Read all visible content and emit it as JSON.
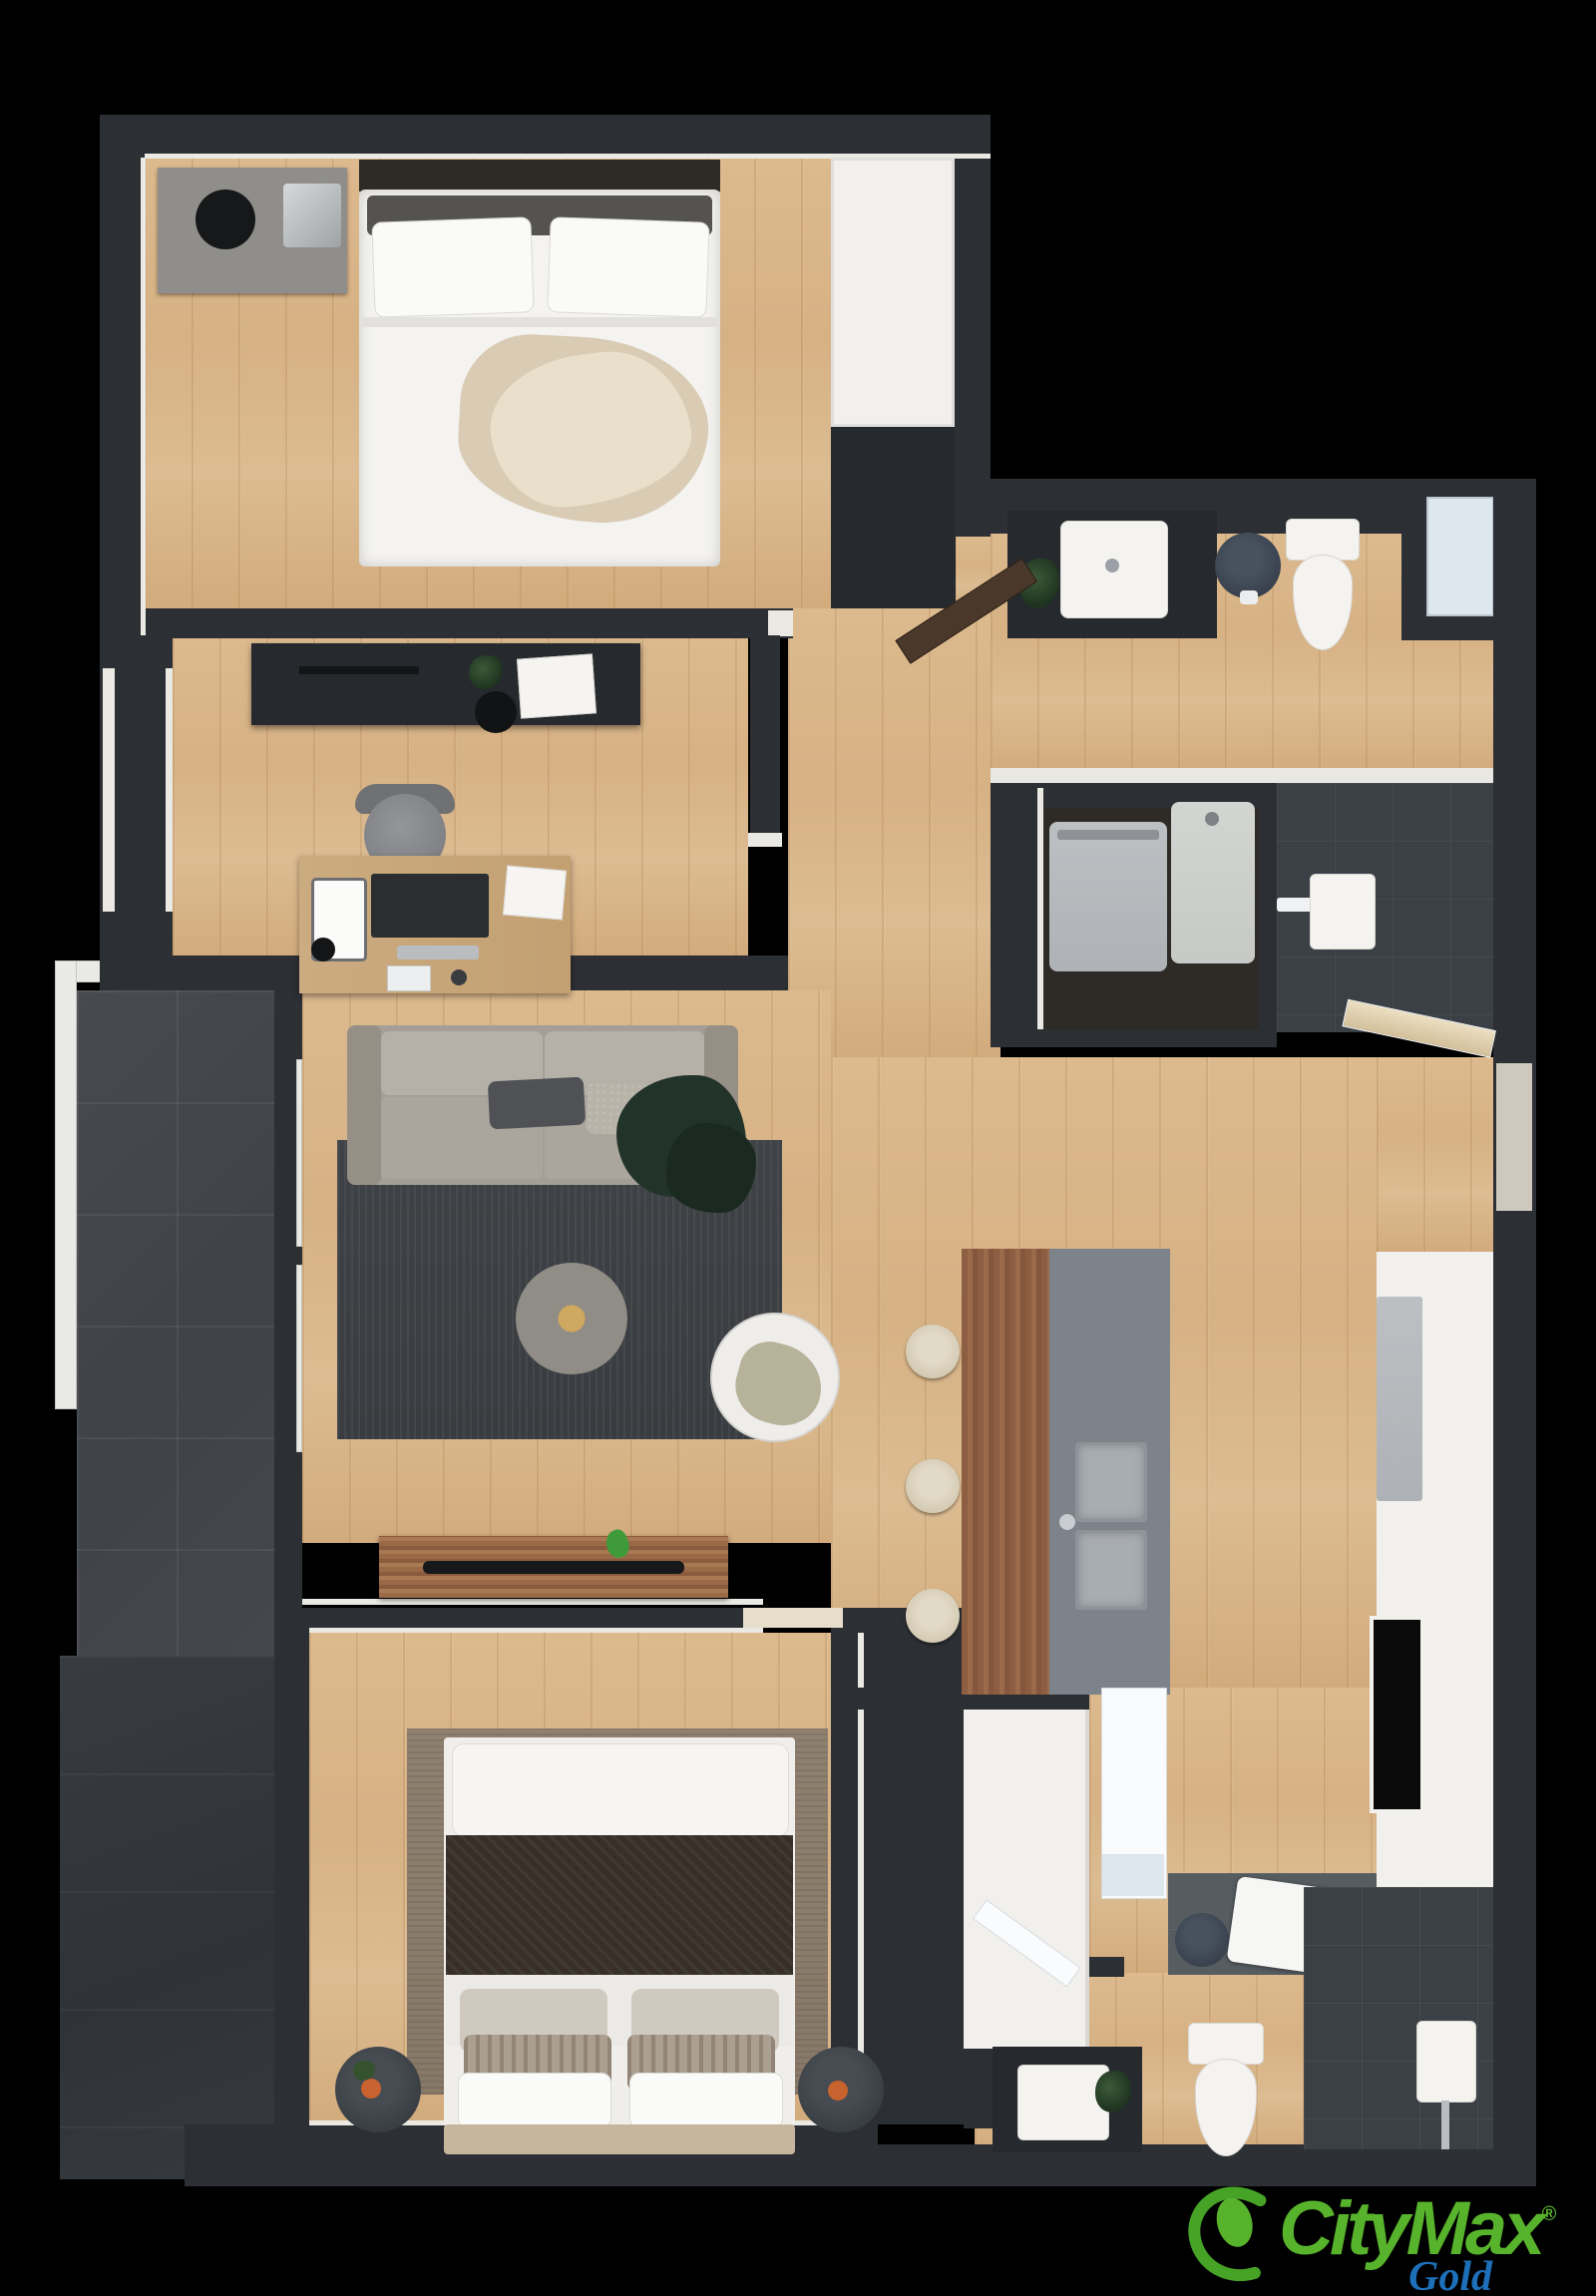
{
  "brand": {
    "name": "CityMax",
    "registered": "®",
    "edition": "Gold",
    "green": "#58b32c",
    "blue": "#1e6fba"
  },
  "plan": {
    "type": "apartment-floor-plan",
    "style": "3d-top-down-render",
    "palette": {
      "background": "#000000",
      "wall": "#2c2f33",
      "wood_floor": "#d6b184",
      "balcony_tile": "#42474c",
      "shower_tile": "#3a4046",
      "living_rug": "#3d4045",
      "bedroom_rug": "#8b7c6c",
      "fixture_white": "#f4f3f0",
      "island_counter": "#7d838b",
      "island_bar_wood": "#8d5e42"
    },
    "rooms": [
      {
        "id": "bedroom-1",
        "label": "Bedroom 1",
        "items": [
          "double-bed",
          "nightstand",
          "white-wardrobe"
        ]
      },
      {
        "id": "office",
        "label": "Office / Second Bedroom",
        "items": [
          "desk",
          "desk-chair",
          "dresser",
          "window"
        ]
      },
      {
        "id": "bathroom-1",
        "label": "Bathroom 1",
        "items": [
          "vanity-sink",
          "plant",
          "stool",
          "toilet",
          "window"
        ]
      },
      {
        "id": "laundry",
        "label": "Laundry Closet",
        "items": [
          "washer",
          "dryer",
          "walk-in-shower"
        ]
      },
      {
        "id": "living-room",
        "label": "Living Room",
        "items": [
          "sofa",
          "area-rug",
          "pouf",
          "side-table",
          "tv-console",
          "balcony-sliding-door"
        ]
      },
      {
        "id": "kitchen",
        "label": "Kitchen / Dining",
        "items": [
          "island-breakfast-bar",
          "bar-stools",
          "double-sink",
          "wall-counter",
          "cooktop",
          "oven",
          "entrance-door",
          "white-wardrobe"
        ]
      },
      {
        "id": "bedroom-2",
        "label": "Bedroom 2",
        "items": [
          "double-bed",
          "area-rug",
          "nightstand-left",
          "nightstand-right"
        ]
      },
      {
        "id": "bathroom-2",
        "label": "Bathroom 2",
        "items": [
          "vanity-sink",
          "toilet",
          "shower",
          "stool",
          "towel"
        ]
      },
      {
        "id": "balcony",
        "label": "Balcony / Terrace",
        "items": [
          "railing",
          "tile-floor"
        ]
      }
    ]
  }
}
